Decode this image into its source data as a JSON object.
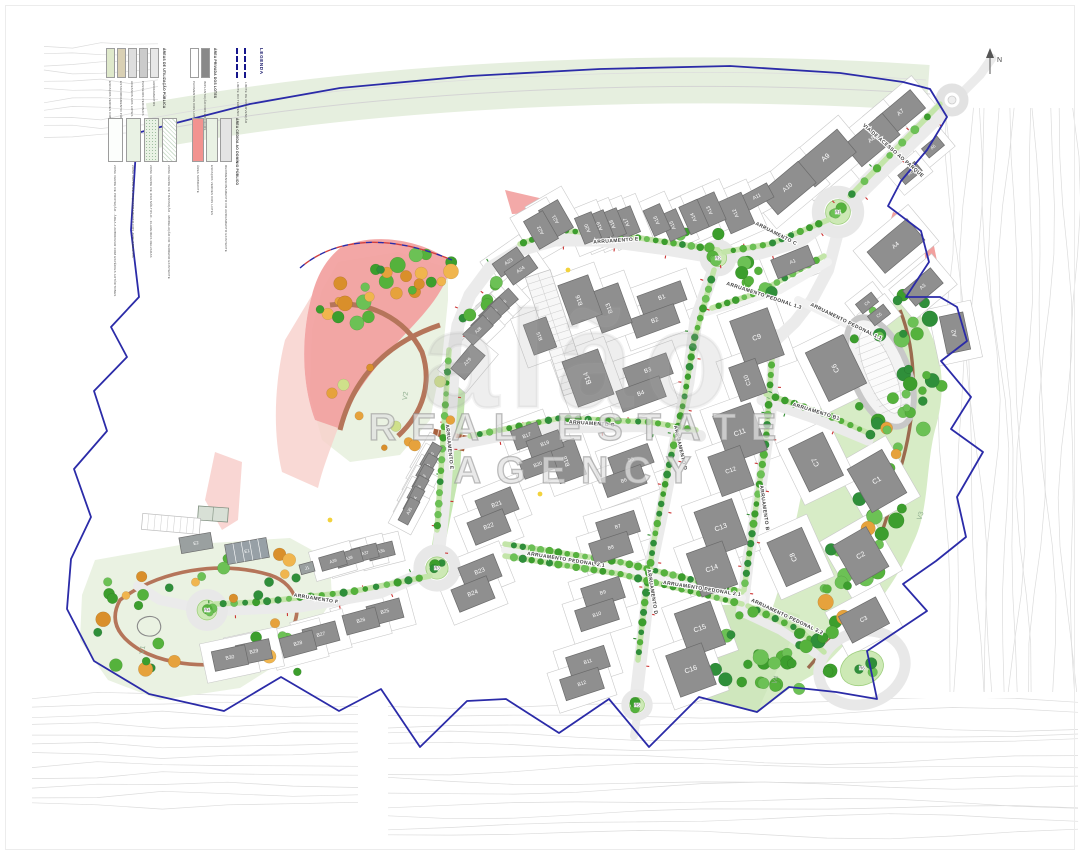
{
  "watermark": {
    "logo": "alão",
    "subtitle": "REAL ESTATE AGENCY"
  },
  "compass": {
    "label": "N"
  },
  "legend": {
    "title": "LEGENDA",
    "boundary_items": [
      {
        "label": "LIMITE DO TERRENO"
      },
      {
        "label": "LIMITE DE INTERVENÇÃO"
      }
    ],
    "groups": [
      {
        "header": "ÁREAS DE UTILIZAÇÃO PÚBLICA",
        "items": [
          {
            "color": "#dfe9cb",
            "label": "ESPAÇOS VERDES COMUNS"
          },
          {
            "color": "#d9d0b4",
            "label": "ESTACIONAMENTO PÚBLICO"
          },
          {
            "color": "#dedede",
            "label": "ACESSOS AOS LOTES"
          },
          {
            "color": "#cbcbcb",
            "label": "PASSEIOS PEDONAIS"
          },
          {
            "color": "#e7e7e7",
            "label": "ARRUAMENTOS"
          }
        ]
      },
      {
        "header": "ÁREA PRIVADA DOS LOTES",
        "items": [
          {
            "color": "#ffffff",
            "label": "PAVIMENTOS DOS LOTES"
          },
          {
            "color": "#898989",
            "label": "IMPLANTAÇÃO DOS EDIFÍCIOS"
          }
        ]
      },
      {
        "header": "",
        "items": [
          {
            "color": "#fcfefc",
            "label": "ZONA VERDE DE PROTEÇÃO - ÁREA A ARBORIZAR COM ESPÉCIES AUTÓCTONES"
          },
          {
            "color": "#e9f2e4",
            "label": "ZONA VERDE DE ENQUADRAMENTO DOS ARRUAMENTOS"
          },
          {
            "color": "#e9f2e4",
            "pattern": "dots",
            "label": "ZONA VERDE DE USO MÚLTIPLO - CLAREIRAS RELVADAS"
          },
          {
            "color": "#ffffff",
            "pattern": "hatch",
            "label": "ZONA VERDE DE TRANSIÇÃO - MODELAÇÃO DO TERRENO EXISTENTE"
          }
        ]
      },
      {
        "header": "ÁREA CEDIDA AO DOMÍNIO PÚBLICO",
        "items": [
          {
            "color": "#f29390",
            "label": "ÁREA SOBRANTE"
          },
          {
            "color": "#e9f2e4",
            "label": "ESPAÇOS VERDES DOS LOTES"
          },
          {
            "color": "#e4e4e4",
            "label": "REDIMENSIONAMENTO DO ARRUAMENTO EXISTENTE"
          }
        ]
      }
    ]
  },
  "map": {
    "streets": [
      {
        "name": "VIA DE ACESSO AO PARQUE",
        "x": 893,
        "y": 151,
        "a": 41
      },
      {
        "name": "ARRUAMENTO C",
        "x": 776,
        "y": 234,
        "a": 27
      },
      {
        "name": "ARRUAMENTO E",
        "x": 616,
        "y": 241,
        "a": -4
      },
      {
        "name": "ARRUAMENTO E",
        "x": 449,
        "y": 447,
        "a": 84
      },
      {
        "name": "ARRUAMENTO F",
        "x": 316,
        "y": 599,
        "a": 9
      },
      {
        "name": "ARRUAMENTO G",
        "x": 592,
        "y": 424,
        "a": 4
      },
      {
        "name": "ARRUAMENTO D",
        "x": 680,
        "y": 448,
        "a": 77
      },
      {
        "name": "ARRUAMENTO D",
        "x": 652,
        "y": 592,
        "a": 81
      },
      {
        "name": "ARRUAMENTO B",
        "x": 764,
        "y": 508,
        "a": 82
      },
      {
        "name": "ARRUAMENTO B1",
        "x": 816,
        "y": 412,
        "a": 17
      },
      {
        "name": "ARRUAMENTO PEDONAL 1.3",
        "x": 764,
        "y": 296,
        "a": 18
      },
      {
        "name": "ARRUAMENTO PEDONAL 1.1",
        "x": 846,
        "y": 322,
        "a": 26
      },
      {
        "name": "ARRUAMENTO PEDONAL 2.1",
        "x": 566,
        "y": 560,
        "a": 9
      },
      {
        "name": "ARRUAMENTO PEDONAL 2.1",
        "x": 702,
        "y": 589,
        "a": 9
      },
      {
        "name": "ARRUAMENTO PEDONAL 2.2",
        "x": 787,
        "y": 617,
        "a": 25
      }
    ],
    "parks": [
      {
        "id": "V1",
        "x": 143,
        "y": 650,
        "a": -78
      },
      {
        "id": "V2",
        "x": 406,
        "y": 396,
        "a": -80
      },
      {
        "id": "V3",
        "x": 921,
        "y": 516,
        "a": -72
      },
      {
        "id": "V4",
        "x": 776,
        "y": 680,
        "a": -72
      }
    ],
    "roundabouts": [
      {
        "id": "R1",
        "x": 838,
        "y": 212,
        "r": 20
      },
      {
        "id": "R2",
        "x": 718,
        "y": 258,
        "r": 14
      },
      {
        "id": "R3",
        "x": 437,
        "y": 568,
        "r": 18
      },
      {
        "id": "R4",
        "x": 207,
        "y": 610,
        "r": 16
      },
      {
        "id": "R5",
        "x": 637,
        "y": 705,
        "r": 12
      },
      {
        "id": "R6",
        "x": 862,
        "y": 668,
        "r": 0
      }
    ],
    "special": [
      {
        "id": "E1",
        "x": 247,
        "y": 551,
        "w": 42,
        "h": 20,
        "a": -10
      },
      {
        "id": "E2",
        "x": 196,
        "y": 543,
        "w": 32,
        "h": 16,
        "a": -10
      },
      {
        "id": "J1",
        "x": 307,
        "y": 568,
        "w": 14,
        "h": 10,
        "a": -15
      }
    ],
    "buildings": [
      {
        "id": "A1",
        "x": 793,
        "y": 262,
        "w": 40,
        "h": 20,
        "a": -22
      },
      {
        "id": "A2",
        "x": 955,
        "y": 333,
        "w": 24,
        "h": 38,
        "a": -12
      },
      {
        "id": "A3",
        "x": 923,
        "y": 287,
        "w": 36,
        "h": 20,
        "a": -40
      },
      {
        "id": "A4",
        "x": 896,
        "y": 246,
        "w": 52,
        "h": 28,
        "a": -40
      },
      {
        "id": "A5",
        "x": 933,
        "y": 147,
        "w": 20,
        "h": 12,
        "a": -40
      },
      {
        "id": "A6",
        "x": 910,
        "y": 173,
        "w": 22,
        "h": 12,
        "a": -40
      },
      {
        "id": "A7",
        "x": 901,
        "y": 113,
        "w": 44,
        "h": 24,
        "a": -40
      },
      {
        "id": "A8",
        "x": 872,
        "y": 140,
        "w": 50,
        "h": 28,
        "a": -40
      },
      {
        "id": "A9",
        "x": 826,
        "y": 158,
        "w": 54,
        "h": 30,
        "a": -40
      },
      {
        "id": "A10",
        "x": 788,
        "y": 188,
        "w": 50,
        "h": 28,
        "a": -40
      },
      {
        "id": "A11",
        "x": 757,
        "y": 197,
        "w": 30,
        "h": 16,
        "a": -28
      },
      {
        "id": "A12",
        "x": 736,
        "y": 213,
        "w": 26,
        "h": 34,
        "a": -24
      },
      {
        "id": "A13",
        "x": 710,
        "y": 210,
        "w": 22,
        "h": 30,
        "a": -24
      },
      {
        "id": "A14",
        "x": 694,
        "y": 217,
        "w": 20,
        "h": 30,
        "a": -24
      },
      {
        "id": "A15",
        "x": 673,
        "y": 225,
        "w": 18,
        "h": 28,
        "a": -24
      },
      {
        "id": "A16",
        "x": 657,
        "y": 220,
        "w": 18,
        "h": 28,
        "a": -24
      },
      {
        "id": "A17",
        "x": 627,
        "y": 222,
        "w": 18,
        "h": 28,
        "a": -22
      },
      {
        "id": "A18",
        "x": 613,
        "y": 224,
        "w": 18,
        "h": 28,
        "a": -22
      },
      {
        "id": "A19",
        "x": 600,
        "y": 226,
        "w": 18,
        "h": 28,
        "a": -22
      },
      {
        "id": "A20",
        "x": 588,
        "y": 228,
        "w": 18,
        "h": 28,
        "a": -22
      },
      {
        "id": "A21",
        "x": 556,
        "y": 219,
        "w": 22,
        "h": 32,
        "a": -30
      },
      {
        "id": "A22",
        "x": 541,
        "y": 230,
        "w": 22,
        "h": 32,
        "a": -30
      },
      {
        "id": "A23",
        "x": 509,
        "y": 262,
        "w": 30,
        "h": 16,
        "a": -35
      },
      {
        "id": "A24",
        "x": 521,
        "y": 270,
        "w": 30,
        "h": 16,
        "a": -35
      },
      {
        "id": "A25",
        "x": 503,
        "y": 303,
        "w": 28,
        "h": 15,
        "a": -42
      },
      {
        "id": "A26",
        "x": 494,
        "y": 312,
        "w": 28,
        "h": 15,
        "a": -42
      },
      {
        "id": "A27",
        "x": 486,
        "y": 321,
        "w": 28,
        "h": 15,
        "a": -44
      },
      {
        "id": "A28",
        "x": 478,
        "y": 330,
        "w": 28,
        "h": 15,
        "a": -44
      },
      {
        "id": "A29",
        "x": 468,
        "y": 362,
        "w": 32,
        "h": 18,
        "a": -50
      },
      {
        "id": "A30",
        "x": 431,
        "y": 456,
        "w": 26,
        "h": 11,
        "a": -60
      },
      {
        "id": "A31",
        "x": 427,
        "y": 467,
        "w": 26,
        "h": 11,
        "a": -60
      },
      {
        "id": "A32",
        "x": 423,
        "y": 478,
        "w": 26,
        "h": 11,
        "a": -61
      },
      {
        "id": "A33",
        "x": 418,
        "y": 489,
        "w": 26,
        "h": 11,
        "a": -61
      },
      {
        "id": "A34",
        "x": 414,
        "y": 500,
        "w": 26,
        "h": 11,
        "a": -62
      },
      {
        "id": "A35",
        "x": 409,
        "y": 511,
        "w": 26,
        "h": 11,
        "a": -62
      },
      {
        "id": "A36",
        "x": 381,
        "y": 551,
        "w": 26,
        "h": 14,
        "a": -14
      },
      {
        "id": "A37",
        "x": 365,
        "y": 553,
        "w": 26,
        "h": 14,
        "a": -14
      },
      {
        "id": "A38",
        "x": 349,
        "y": 558,
        "w": 26,
        "h": 14,
        "a": -16
      },
      {
        "id": "A39",
        "x": 333,
        "y": 561,
        "w": 26,
        "h": 14,
        "a": -16
      },
      {
        "id": "B1",
        "x": 662,
        "y": 298,
        "w": 46,
        "h": 20,
        "a": -20
      },
      {
        "id": "B2",
        "x": 655,
        "y": 321,
        "w": 46,
        "h": 20,
        "a": -20
      },
      {
        "id": "B3",
        "x": 648,
        "y": 371,
        "w": 46,
        "h": 22,
        "a": -20
      },
      {
        "id": "B4",
        "x": 641,
        "y": 394,
        "w": 46,
        "h": 22,
        "a": -20
      },
      {
        "id": "B5",
        "x": 631,
        "y": 460,
        "w": 42,
        "h": 20,
        "a": -20
      },
      {
        "id": "B6",
        "x": 624,
        "y": 481,
        "w": 42,
        "h": 20,
        "a": -20
      },
      {
        "id": "B7",
        "x": 618,
        "y": 527,
        "w": 40,
        "h": 22,
        "a": -18
      },
      {
        "id": "B8",
        "x": 611,
        "y": 548,
        "w": 40,
        "h": 22,
        "a": -18
      },
      {
        "id": "B9",
        "x": 603,
        "y": 593,
        "w": 40,
        "h": 22,
        "a": -18
      },
      {
        "id": "B10",
        "x": 597,
        "y": 615,
        "w": 40,
        "h": 22,
        "a": -18
      },
      {
        "id": "B11",
        "x": 588,
        "y": 662,
        "w": 40,
        "h": 22,
        "a": -18
      },
      {
        "id": "B12",
        "x": 582,
        "y": 684,
        "w": 40,
        "h": 22,
        "a": -18
      },
      {
        "id": "B13",
        "x": 610,
        "y": 308,
        "w": 32,
        "h": 42,
        "a": -20
      },
      {
        "id": "B14",
        "x": 588,
        "y": 378,
        "w": 38,
        "h": 48,
        "a": -20
      },
      {
        "id": "B15",
        "x": 540,
        "y": 336,
        "w": 24,
        "h": 32,
        "a": -20
      },
      {
        "id": "B16",
        "x": 580,
        "y": 300,
        "w": 32,
        "h": 42,
        "a": -20
      },
      {
        "id": "B17",
        "x": 527,
        "y": 436,
        "w": 28,
        "h": 20,
        "a": -20
      },
      {
        "id": "B18",
        "x": 567,
        "y": 461,
        "w": 28,
        "h": 38,
        "a": -20
      },
      {
        "id": "B19",
        "x": 545,
        "y": 444,
        "w": 34,
        "h": 18,
        "a": -20
      },
      {
        "id": "B20",
        "x": 538,
        "y": 465,
        "w": 34,
        "h": 18,
        "a": -20
      },
      {
        "id": "B21",
        "x": 497,
        "y": 505,
        "w": 38,
        "h": 24,
        "a": -22
      },
      {
        "id": "B22",
        "x": 489,
        "y": 527,
        "w": 38,
        "h": 24,
        "a": -22
      },
      {
        "id": "B23",
        "x": 480,
        "y": 572,
        "w": 38,
        "h": 24,
        "a": -22
      },
      {
        "id": "B24",
        "x": 473,
        "y": 594,
        "w": 38,
        "h": 24,
        "a": -22
      },
      {
        "id": "B25",
        "x": 385,
        "y": 612,
        "w": 34,
        "h": 20,
        "a": -15
      },
      {
        "id": "B26",
        "x": 361,
        "y": 621,
        "w": 34,
        "h": 20,
        "a": -15
      },
      {
        "id": "B27",
        "x": 321,
        "y": 635,
        "w": 34,
        "h": 20,
        "a": -15
      },
      {
        "id": "B28",
        "x": 298,
        "y": 644,
        "w": 34,
        "h": 20,
        "a": -15
      },
      {
        "id": "B29",
        "x": 254,
        "y": 652,
        "w": 34,
        "h": 20,
        "a": -12
      },
      {
        "id": "B30",
        "x": 230,
        "y": 658,
        "w": 34,
        "h": 20,
        "a": -12
      },
      {
        "id": "C1",
        "x": 877,
        "y": 481,
        "w": 40,
        "h": 50,
        "a": -30
      },
      {
        "id": "C2",
        "x": 861,
        "y": 556,
        "w": 38,
        "h": 46,
        "a": -30
      },
      {
        "id": "C3",
        "x": 864,
        "y": 620,
        "w": 42,
        "h": 30,
        "a": -28
      },
      {
        "id": "C4",
        "x": 867,
        "y": 303,
        "w": 20,
        "h": 12,
        "a": -38
      },
      {
        "id": "C5",
        "x": 879,
        "y": 315,
        "w": 20,
        "h": 12,
        "a": -38
      },
      {
        "id": "C6",
        "x": 836,
        "y": 368,
        "w": 42,
        "h": 54,
        "a": -26
      },
      {
        "id": "C7",
        "x": 816,
        "y": 462,
        "w": 38,
        "h": 48,
        "a": -26
      },
      {
        "id": "C8",
        "x": 794,
        "y": 557,
        "w": 38,
        "h": 48,
        "a": -24
      },
      {
        "id": "C9",
        "x": 757,
        "y": 338,
        "w": 40,
        "h": 50,
        "a": -20
      },
      {
        "id": "C10",
        "x": 748,
        "y": 380,
        "w": 28,
        "h": 36,
        "a": -20
      },
      {
        "id": "C11",
        "x": 740,
        "y": 433,
        "w": 40,
        "h": 50,
        "a": -20
      },
      {
        "id": "C12",
        "x": 731,
        "y": 471,
        "w": 34,
        "h": 42,
        "a": -20
      },
      {
        "id": "C13",
        "x": 721,
        "y": 528,
        "w": 40,
        "h": 48,
        "a": -20
      },
      {
        "id": "C14",
        "x": 712,
        "y": 569,
        "w": 38,
        "h": 46,
        "a": -20
      },
      {
        "id": "C15",
        "x": 700,
        "y": 629,
        "w": 38,
        "h": 46,
        "a": -20
      },
      {
        "id": "C16",
        "x": 691,
        "y": 670,
        "w": 38,
        "h": 44,
        "a": -20
      }
    ]
  },
  "colors": {
    "boundary": "#2b2ba8",
    "surplus_pink": "#f2a09e",
    "surplus_pale": "#f8cfcb",
    "park_green": "#eaf2e2",
    "belt_green": "#d7ecc6",
    "building_gray": "#8f8f8f",
    "road_gray": "#ebebeb",
    "tree_green": "#3faa28",
    "tree_orange": "#e8a43c",
    "path_brown": "#b5755a",
    "contour_gray": "#dcdcdc"
  }
}
